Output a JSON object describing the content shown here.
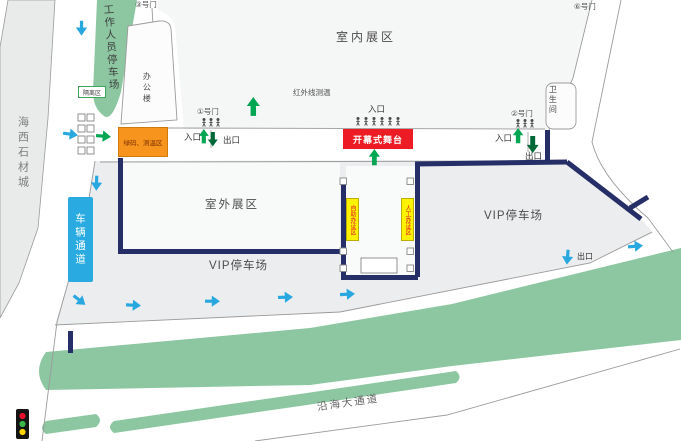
{
  "map": {
    "regions": {
      "indoor_exhibition": "室内展区",
      "outdoor_exhibition": "室外展区",
      "staff_parking": "工作人员停车场",
      "vip_parking_main": "VIP停车场",
      "vip_parking_east": "VIP停车场",
      "haixi_stone_city": "海西石材城",
      "coastal_avenue": "沿海大通道",
      "office_building": "办公楼",
      "restroom": "卫生间",
      "vehicle_channel": "车辆通道"
    },
    "gates": {
      "gate_1": "①号门",
      "gate_2": "②号门",
      "gate_3": "③号门",
      "gate_6": "⑥号门"
    },
    "flow": {
      "entrance": "入口",
      "exit": "出口"
    },
    "facilities": {
      "opening_stage": "开幕式舞台",
      "green_code_temp_zone": "绿码、测温区",
      "isolation_zone": "隔离区",
      "infrared_temp_check": "红外线测温",
      "self_badge_zone": "自助办证区",
      "manual_badge_zone": "人工办证区"
    },
    "icons": {
      "blue_flow_arrow": "vehicle-flow-arrow",
      "green_up_arrow": "entry-arrow",
      "green_down_arrow": "exit-arrow",
      "pedestrian": "pedestrian-icon",
      "traffic_light": "traffic-light-icon",
      "turnstile": "turnstile-icon"
    },
    "colors": {
      "navy_barrier": "#252e66",
      "blue_arrow": "#29a8e0",
      "green_up_arrow": "#00a651",
      "green_down_arrow": "#006837",
      "stage_red": "#ed1c24",
      "checkpoint_orange": "#f7941d",
      "badge_yellow": "#fff200",
      "greenery": "#8cc7a1",
      "vehicle_channel_blue": "#29abe2"
    }
  }
}
